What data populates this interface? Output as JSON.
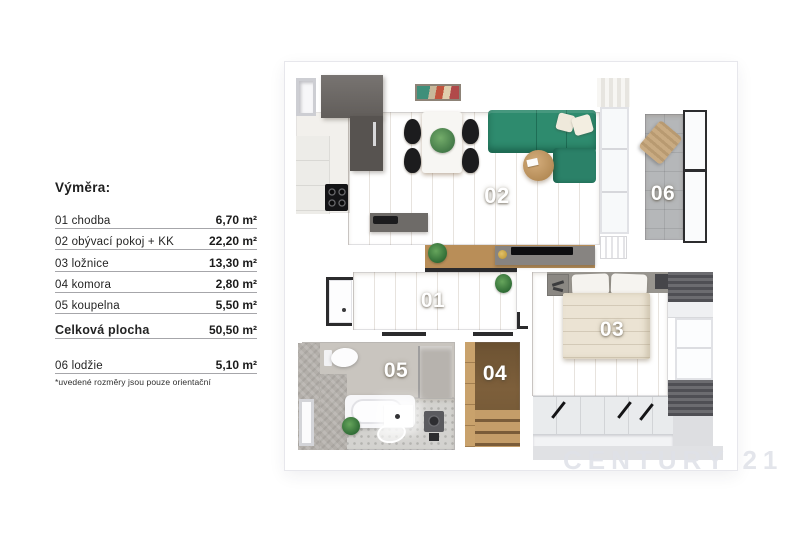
{
  "legend": {
    "title": "Výměra:",
    "rows": [
      {
        "label": "01 chodba",
        "value": "6,70 m²"
      },
      {
        "label": "02 obývací pokoj + KK",
        "value": "22,20 m²"
      },
      {
        "label": "03 ložnice",
        "value": "13,30 m²"
      },
      {
        "label": "04 komora",
        "value": "2,80 m²"
      },
      {
        "label": "05 koupelna",
        "value": "5,50 m²"
      }
    ],
    "total": {
      "label": "Celková plocha",
      "value": "50,50 m²"
    },
    "loggia": {
      "label": "06 lodžie",
      "value": "5,10 m²"
    },
    "disclaimer": "*uvedené rozměry jsou pouze orientační"
  },
  "floorplan": {
    "rooms": [
      {
        "number": "01",
        "name": "chodba"
      },
      {
        "number": "02",
        "name": "obývací pokoj + KK"
      },
      {
        "number": "03",
        "name": "ložnice"
      },
      {
        "number": "04",
        "name": "komora"
      },
      {
        "number": "05",
        "name": "koupelna"
      },
      {
        "number": "06",
        "name": "lodžie"
      }
    ]
  },
  "watermark": "CENTURY 21",
  "colors": {
    "sofa_green": "#2e8b6e",
    "wood_floor": "#c69e66",
    "hall_wood": "#a67f4c",
    "cabinet_dark": "#5f5b57",
    "loggia_tile": "#b5b7b9",
    "bath_wall": "#c9c5bf",
    "legend_text": "#222222"
  }
}
